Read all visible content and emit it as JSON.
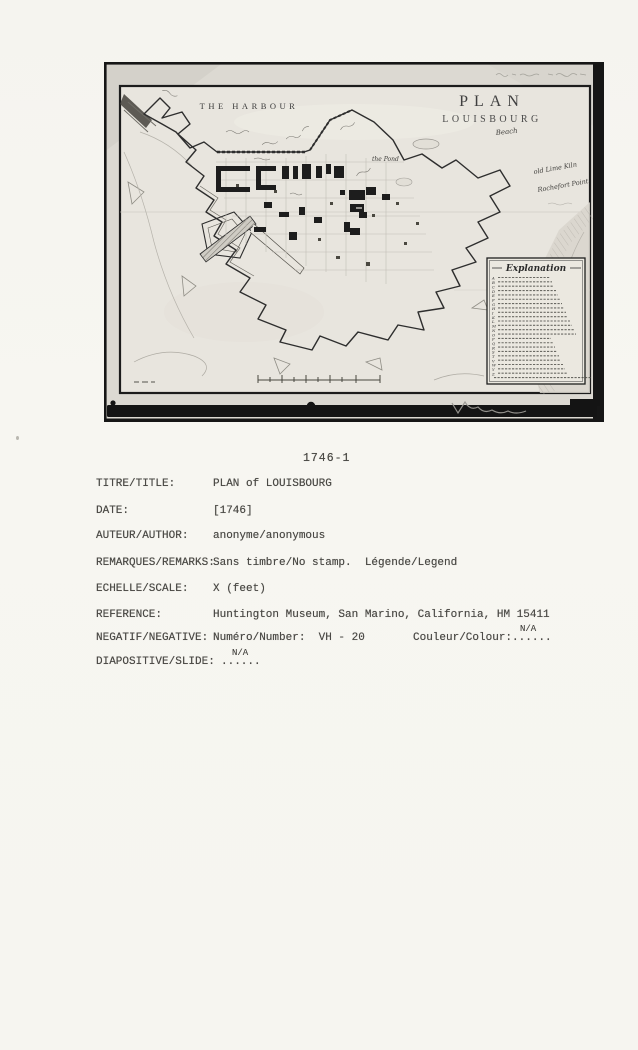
{
  "photo": {
    "map": {
      "harbour_label": "THE HARBOUR",
      "title_line1": "PLAN",
      "title_line2": "LOUISBOURG",
      "labels": {
        "beach": "Beach",
        "old_lime_kiln": "old Lime Kiln",
        "rochefort_point": "Rochefort Point",
        "the_pond": "the Pond"
      },
      "legend": {
        "title": "Explanation",
        "letters": [
          "A",
          "B",
          "C",
          "D",
          "E",
          "F",
          "G",
          "H",
          "I",
          "K",
          "L",
          "M",
          "N",
          "O",
          "P",
          "Q",
          "R",
          "S",
          "T",
          "V",
          "W",
          "Y",
          "Z",
          ""
        ]
      }
    }
  },
  "catalog": {
    "number": "1746-1",
    "rows": [
      {
        "label": "TITRE/TITLE:",
        "value": "PLAN of LOUISBOURG"
      },
      {
        "label": "DATE:",
        "value": "[1746]"
      },
      {
        "label": "AUTEUR/AUTHOR:",
        "value": "anonyme/anonymous"
      },
      {
        "label": "REMARQUES/REMARKS:",
        "value": "Sans timbre/No stamp.  Légende/Legend"
      },
      {
        "label": "ECHELLE/SCALE:",
        "value": "X (feet)"
      },
      {
        "label": "REFERENCE:",
        "value": "Huntington Museum, San Marino, California, HM 15411"
      }
    ],
    "negative_row": {
      "label": "NEGATIF/NEGATIVE:",
      "number": "Numéro/Number:  VH - 20",
      "colour": "Couleur/Colour:......",
      "na": "N/A"
    },
    "slide_row": {
      "label": "DIAPOSITIVE/SLIDE:",
      "dots": "......",
      "na": "N/A"
    }
  },
  "colors": {
    "paper": "#f6f5f0",
    "photo_margin": "#dcd9d2",
    "map_paper": "#e8e5de",
    "ink": "#2e2e2e",
    "frame_black": "#161616",
    "type_ink": "#4b4a46"
  }
}
